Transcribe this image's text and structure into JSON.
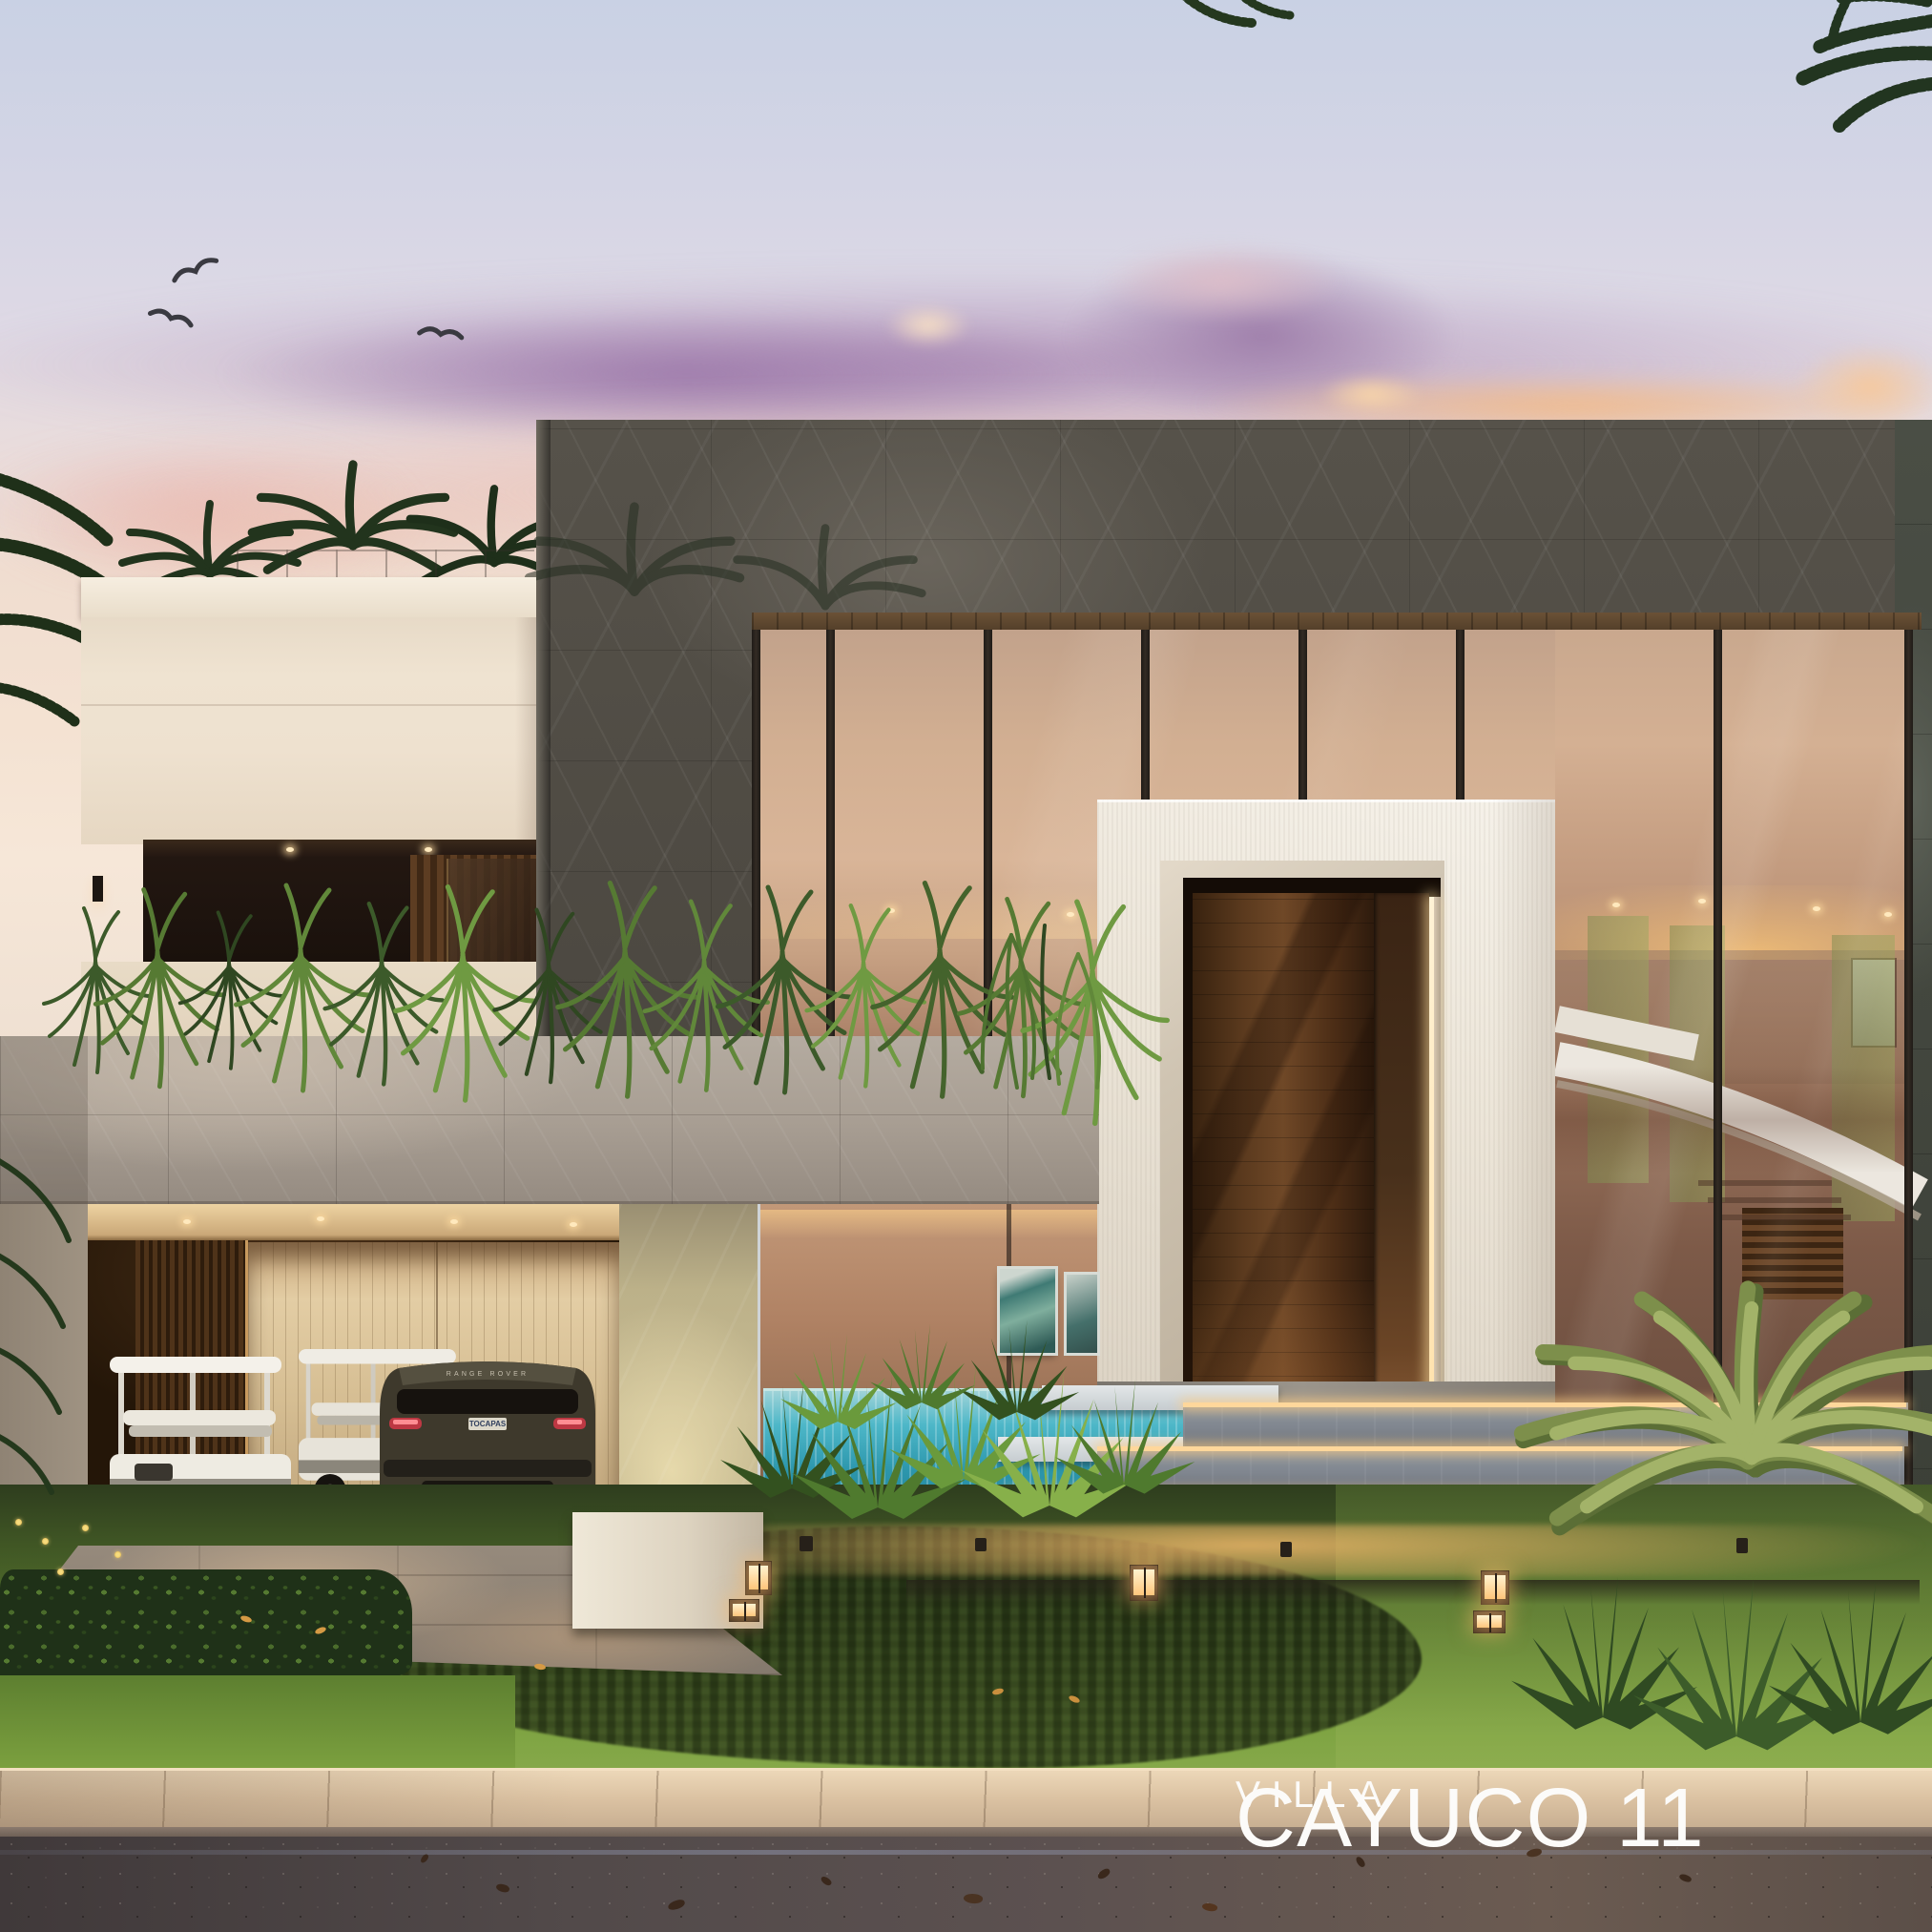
{
  "watermark": {
    "line1": "VILLA",
    "line2": "CAYUCO 11"
  },
  "vehicle": {
    "badge": "RANGE ROVER",
    "plate": "TOCAPAS"
  },
  "colors": {
    "sky-top": "#c9d1e4",
    "sky-pink": "#f0ddd0",
    "cloud-purple": "#a886b2",
    "cloud-orange": "#f4b982",
    "stone-dark": "#55514a",
    "stone-light": "#b0a79c",
    "white-stucco": "#f3efe7",
    "glass-warm": "#d2af92",
    "door-wood": "#5b3a1e",
    "led-glow": "#ffd79b",
    "pool-teal": "#2c96ac",
    "lawn-green": "#6c8f38",
    "sidewalk-beige": "#dcc3a3",
    "road-asphalt": "#4b4240",
    "text-white": "#fcfbf9"
  }
}
